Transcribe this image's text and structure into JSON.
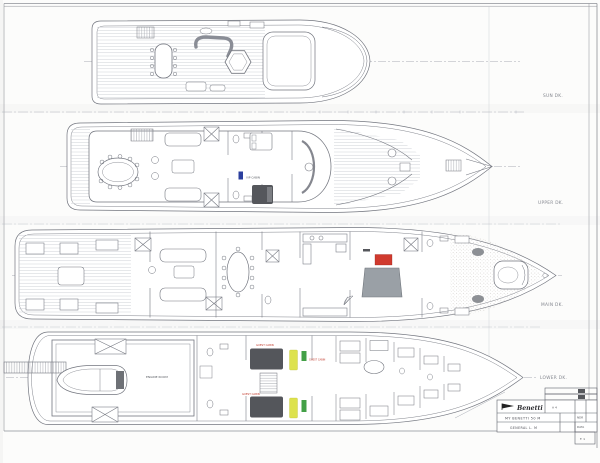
{
  "sheet": {
    "background": "#fcfcfb",
    "ink_color": "#73767f",
    "faint_color": "#b8bcc4"
  },
  "decks": [
    {
      "id": "sun-deck",
      "label": "SUN DK."
    },
    {
      "id": "upper-deck",
      "label": "UPPER DK."
    },
    {
      "id": "main-deck",
      "label": "MAIN DK."
    },
    {
      "id": "lower-deck",
      "label": "LOWER DK."
    }
  ],
  "room_labels": {
    "engine_room": "ENGINE ROOM",
    "vip_cabin": "VIP CABIN",
    "guest_cabin_port": "GUEST CABIN",
    "guest_cabin_stbd": "GUEST CABIN",
    "guest_cabin_small": "GUEST CABIN"
  },
  "highlights": {
    "red": "#d03a2e",
    "blue": "#2b3f9e",
    "yellow": "#dde24d",
    "green": "#43a047",
    "label_red": "#c0392b"
  },
  "title_block": {
    "logo_text": "Benetti",
    "sheet_code": "A 4",
    "project_line": "MY BENETTI 50 M",
    "drawing_line": "GENERAL  L. M",
    "field_1": "NDR",
    "field_2": "DATA",
    "page_note": "F. 1"
  }
}
